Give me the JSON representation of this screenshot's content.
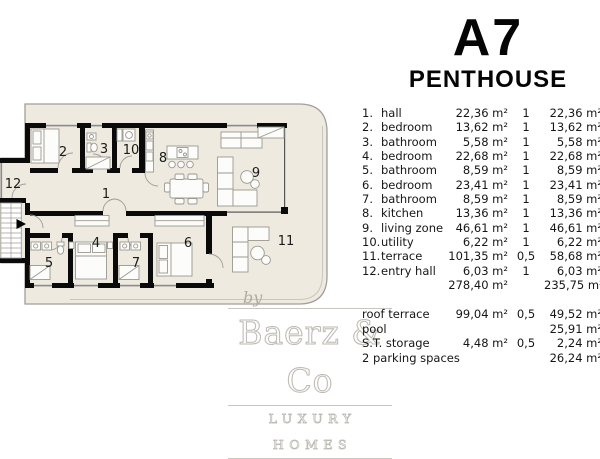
{
  "header": {
    "title": "A7",
    "subtitle": "PENTHOUSE"
  },
  "area_table": {
    "rows": [
      {
        "num": "1.",
        "name": "hall",
        "area": "22,36 m²",
        "factor": "1",
        "weighted": "22,36 m²"
      },
      {
        "num": "2.",
        "name": "bedroom",
        "area": "13,62 m²",
        "factor": "1",
        "weighted": "13,62 m²"
      },
      {
        "num": "3.",
        "name": "bathroom",
        "area": "5,58 m²",
        "factor": "1",
        "weighted": "5,58 m²"
      },
      {
        "num": "4.",
        "name": "bedroom",
        "area": "22,68 m²",
        "factor": "1",
        "weighted": "22,68 m²"
      },
      {
        "num": "5.",
        "name": "bathroom",
        "area": "8,59 m²",
        "factor": "1",
        "weighted": "8,59 m²"
      },
      {
        "num": "6.",
        "name": "bedroom",
        "area": "23,41 m²",
        "factor": "1",
        "weighted": "23,41 m²"
      },
      {
        "num": "7.",
        "name": "bathroom",
        "area": "8,59 m²",
        "factor": "1",
        "weighted": "8,59 m²"
      },
      {
        "num": "8.",
        "name": "kitchen",
        "area": "13,36 m²",
        "factor": "1",
        "weighted": "13,36 m²"
      },
      {
        "num": "9.",
        "name": "living zone",
        "area": "46,61 m²",
        "factor": "1",
        "weighted": "46,61 m²"
      },
      {
        "num": "10.",
        "name": "utility",
        "area": "6,22 m²",
        "factor": "1",
        "weighted": "6,22 m²"
      },
      {
        "num": "11.",
        "name": "terrace",
        "area": "101,35 m²",
        "factor": "0,5",
        "weighted": "58,68 m²"
      },
      {
        "num": "12.",
        "name": "entry hall",
        "area": "6,03 m²",
        "factor": "1",
        "weighted": "6,03 m²"
      }
    ],
    "total": {
      "area": "278,40 m²",
      "weighted": "235,75 m²"
    },
    "extras": [
      {
        "name": "roof terrace",
        "area": "99,04 m²",
        "factor": "0,5",
        "weighted": "49,52 m²"
      },
      {
        "name": "pool",
        "area": "",
        "factor": "",
        "weighted": "25,91 m²"
      },
      {
        "name": "S.T. storage",
        "area": "4,48 m²",
        "factor": "0,5",
        "weighted": "2,24 m²"
      },
      {
        "name": "2 parking spaces",
        "area": "",
        "factor": "",
        "weighted": "26,24 m²"
      }
    ]
  },
  "plan": {
    "rooms": [
      {
        "label": "1"
      },
      {
        "label": "2"
      },
      {
        "label": "3"
      },
      {
        "label": "4"
      },
      {
        "label": "5"
      },
      {
        "label": "6"
      },
      {
        "label": "7"
      },
      {
        "label": "8"
      },
      {
        "label": "9"
      },
      {
        "label": "10"
      },
      {
        "label": "11"
      },
      {
        "label": "12"
      }
    ]
  },
  "watermark": {
    "by": "by",
    "brand": "Baerz & Co",
    "tagline": "LUXURY HOMES"
  },
  "colors": {
    "floor": "#eeeae0",
    "wall": "#0a0a0a",
    "boundary": "#a39f99",
    "window": "#8a8a8a",
    "furniture": "#9b9890",
    "text": "#161616",
    "watermark": "#bdbab4"
  }
}
